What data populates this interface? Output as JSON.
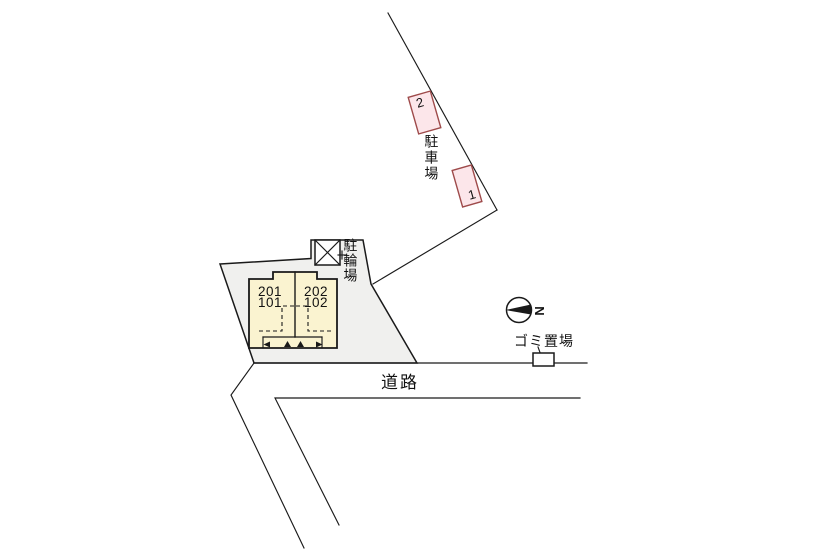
{
  "colors": {
    "line": "#1a1a1a",
    "lot_fill": "#f0f0ee",
    "building_fill": "#faf3d0",
    "parking_fill": "#fce6ea",
    "parking_border": "#9e4a4a"
  },
  "parking_area": {
    "label": "駐車場",
    "spaces": [
      {
        "number": "2"
      },
      {
        "number": "1"
      }
    ]
  },
  "bicycle_area": {
    "label": "駐輪場"
  },
  "building": {
    "units": [
      {
        "upper": "201",
        "lower": "101"
      },
      {
        "upper": "202",
        "lower": "102"
      }
    ]
  },
  "garbage_area": {
    "label": "ゴミ置場"
  },
  "road": {
    "label": "道路"
  },
  "compass": {
    "north_label": "N"
  }
}
